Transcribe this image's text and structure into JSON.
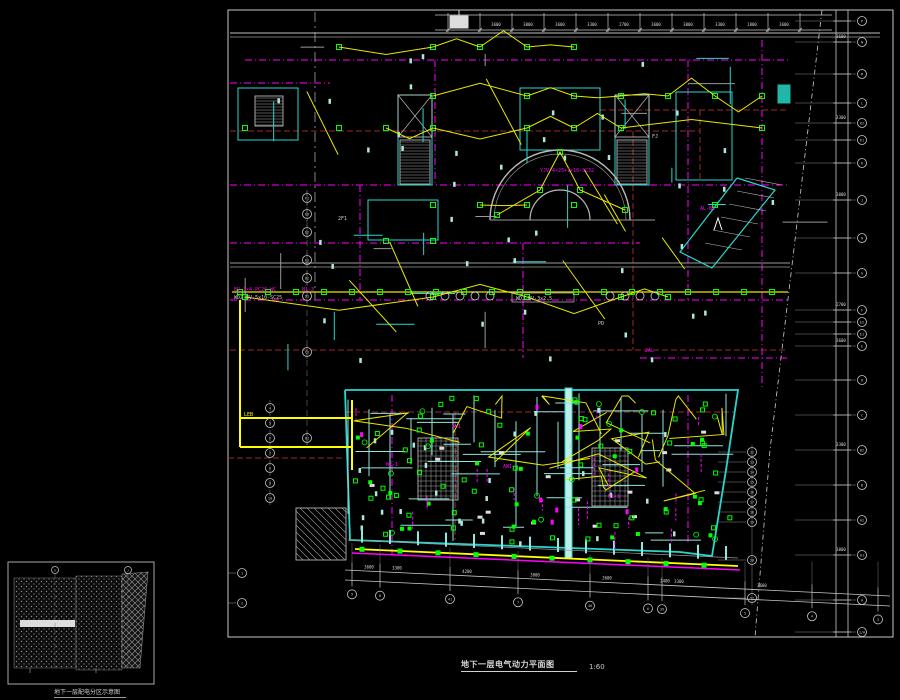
{
  "sheet": {
    "title": "地下一层电气动力平面图",
    "scale": "1:60"
  },
  "inset": {
    "label": "地下一层配电分区示意图"
  },
  "palette": {
    "frame": "#c8c8c8",
    "wall_gray": "#9a9a9a",
    "wall_cyan": "#27d8cf",
    "wall_cyan_soft": "#8fe8de",
    "circuit_yellow": "#e8e800",
    "bright_yellow": "#ffff00",
    "device_green": "#00ff00",
    "power_magenta": "#ff00ff",
    "fire_maroon": "#9a2a2a",
    "text_white": "#cfcfcf",
    "pale_mark": "#aee8dc",
    "riser_fill": "#bfeee8",
    "accent_teal": "#1fb8a8"
  },
  "grid_bubbles": {
    "right": [
      {
        "y": 21,
        "label": "P"
      },
      {
        "y": 42,
        "label": "N"
      },
      {
        "y": 74,
        "label": "M"
      },
      {
        "y": 103,
        "label": "L"
      },
      {
        "y": 123,
        "label": "K2"
      },
      {
        "y": 140,
        "label": "K1"
      },
      {
        "y": 163,
        "label": "K"
      },
      {
        "y": 200,
        "label": "J"
      },
      {
        "y": 238,
        "label": "H"
      },
      {
        "y": 273,
        "label": "G"
      },
      {
        "y": 310,
        "label": "F"
      },
      {
        "y": 322,
        "label": "E2"
      },
      {
        "y": 334,
        "label": "E1"
      },
      {
        "y": 346,
        "label": "E"
      },
      {
        "y": 380,
        "label": "D"
      },
      {
        "y": 415,
        "label": "C"
      },
      {
        "y": 450,
        "label": "B2"
      },
      {
        "y": 485,
        "label": "B"
      },
      {
        "y": 520,
        "label": "A2"
      },
      {
        "y": 555,
        "label": "A1"
      },
      {
        "y": 600,
        "label": "A"
      },
      {
        "y": 632,
        "label": "1/A"
      }
    ],
    "left_upper": [
      {
        "y": 198,
        "label": "F1"
      },
      {
        "y": 214,
        "label": "E3"
      },
      {
        "y": 232,
        "label": "E2"
      },
      {
        "y": 260,
        "label": "E1"
      },
      {
        "y": 278,
        "label": "D2"
      },
      {
        "y": 296,
        "label": "D1"
      },
      {
        "y": 352,
        "label": "C1"
      },
      {
        "y": 438,
        "label": "B1"
      }
    ],
    "left_lower": [
      {
        "y": 408,
        "label": "4"
      },
      {
        "y": 423,
        "label": "5"
      },
      {
        "y": 438,
        "label": "6"
      },
      {
        "y": 453,
        "label": "7"
      },
      {
        "y": 468,
        "label": "8"
      },
      {
        "y": 483,
        "label": "9"
      },
      {
        "y": 498,
        "label": "10"
      }
    ],
    "right_lower": [
      {
        "y": 452,
        "label": "12"
      },
      {
        "y": 462,
        "label": "13"
      },
      {
        "y": 472,
        "label": "14"
      },
      {
        "y": 482,
        "label": "15"
      },
      {
        "y": 492,
        "label": "16"
      },
      {
        "y": 502,
        "label": "17"
      },
      {
        "y": 512,
        "label": "18"
      },
      {
        "y": 522,
        "label": "19"
      },
      {
        "y": 560,
        "label": "20"
      },
      {
        "y": 598,
        "label": "21"
      }
    ],
    "bottom": [
      {
        "x": 352,
        "label": "9"
      },
      {
        "x": 380,
        "label": "8"
      },
      {
        "x": 450,
        "label": "41"
      },
      {
        "x": 518,
        "label": "7"
      },
      {
        "x": 590,
        "label": "40"
      },
      {
        "x": 648,
        "label": "6"
      },
      {
        "x": 662,
        "label": "39"
      },
      {
        "x": 745,
        "label": "5"
      },
      {
        "x": 812,
        "label": "4"
      },
      {
        "x": 878,
        "label": "3"
      }
    ],
    "frame_left": [
      {
        "y": 573,
        "label": "1"
      },
      {
        "y": 603,
        "label": "2"
      }
    ],
    "inset": [
      {
        "x": 55,
        "label": "D"
      },
      {
        "x": 128,
        "label": "J"
      }
    ]
  },
  "dim_numbers": {
    "top": [
      "3300",
      "3600",
      "3000",
      "3600",
      "3300",
      "2700",
      "3600",
      "3000",
      "3300",
      "1800",
      "3600"
    ],
    "right": [
      "3600",
      "3300",
      "3000",
      "2700",
      "3600",
      "3300",
      "3000",
      "3600"
    ],
    "bottom": [
      "3600",
      "3300",
      "4200",
      "3000",
      "3600",
      "2400",
      "3300",
      "3600"
    ]
  },
  "annotations": [
    {
      "t": "BV-3×4-PC20-WC",
      "x": 234,
      "y": 291,
      "c": "magenta",
      "s": 5
    },
    {
      "t": "WDZ-BV-5×10-SC25",
      "x": 234,
      "y": 299,
      "c": "white",
      "s": 5
    },
    {
      "t": "N1-3",
      "x": 302,
      "y": 291,
      "c": "magenta",
      "s": 5
    },
    {
      "t": "YJV-4×25+1×16-SC32",
      "x": 540,
      "y": 172,
      "c": "magenta",
      "s": 5
    },
    {
      "t": "AL-B1",
      "x": 700,
      "y": 210,
      "c": "magenta",
      "s": 5
    },
    {
      "t": "N2-1",
      "x": 386,
      "y": 466,
      "c": "magenta",
      "s": 5
    },
    {
      "t": "AL1",
      "x": 452,
      "y": 428,
      "c": "magenta",
      "s": 5
    },
    {
      "t": "AW1",
      "x": 503,
      "y": 468,
      "c": "magenta",
      "s": 5
    },
    {
      "t": "N1-1",
      "x": 608,
      "y": 498,
      "c": "magenta",
      "s": 5
    },
    {
      "t": "2AL",
      "x": 645,
      "y": 352,
      "c": "magenta",
      "s": 5
    },
    {
      "t": "PD",
      "x": 598,
      "y": 325,
      "c": "white",
      "s": 5
    },
    {
      "t": "FJ",
      "x": 652,
      "y": 138,
      "c": "white",
      "s": 5
    },
    {
      "t": "2F1",
      "x": 338,
      "y": 220,
      "c": "white",
      "s": 5
    },
    {
      "t": "LEB",
      "x": 244,
      "y": 416,
      "c": "yellow",
      "s": 5
    }
  ],
  "boxed_label": {
    "t": "WDZ-BV-3×2.5",
    "x": 516,
    "y": 300
  }
}
